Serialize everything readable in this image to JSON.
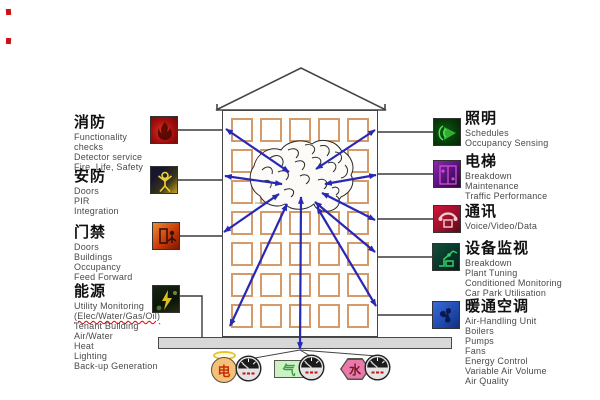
{
  "left_groups": [
    {
      "id": "fire",
      "title": "消防",
      "lines": [
        "Functionality",
        "checks",
        "Detector service",
        "Fire, Life, Safety"
      ]
    },
    {
      "id": "security",
      "title": "安防",
      "lines": [
        "Doors",
        "PIR",
        "Integration"
      ]
    },
    {
      "id": "access",
      "title": "门禁",
      "lines": [
        "Doors",
        "Buildings",
        "Occupancy",
        "Feed Forward"
      ]
    },
    {
      "id": "energy",
      "title": "能源",
      "lines": [
        "Utility Monitoring",
        "(Elec/Water/Gas/Oil)",
        "Tenant Building",
        "Air/Water",
        "Heat",
        "Lighting",
        "Back-up Generation"
      ]
    }
  ],
  "right_groups": [
    {
      "id": "lighting",
      "title": "照明",
      "lines": [
        "Schedules",
        "Occupancy Sensing"
      ]
    },
    {
      "id": "elevator",
      "title": "电梯",
      "lines": [
        "Breakdown",
        "Maintenance",
        "Traffic Performance"
      ]
    },
    {
      "id": "comms",
      "title": "通讯",
      "lines": [
        "Voice/Video/Data"
      ]
    },
    {
      "id": "equipment",
      "title": "设备监视",
      "lines": [
        "Breakdown",
        "Plant Tuning",
        "Conditioned Monitoring",
        "Car Park Utilisation"
      ]
    },
    {
      "id": "hvac",
      "title": "暖通空调",
      "lines": [
        "Air-Handling Unit",
        "Boilers",
        "Pumps",
        "Fans",
        "Energy Control",
        "Variable Air Volume",
        "Air Quality"
      ]
    }
  ],
  "meters": [
    {
      "id": "electricity",
      "label": "电"
    },
    {
      "id": "gas",
      "label": "气"
    },
    {
      "id": "water",
      "label": "水"
    }
  ],
  "building": {
    "window_rows": 7,
    "window_cols": 5
  },
  "spellcheck_underlined": [
    "(Elec/Water/Gas/Oil)"
  ],
  "colors": {
    "arrow": "#2828b4",
    "window-border": "#d49a6a",
    "base-bar": "#d8d8d8",
    "electric": "#f5c078",
    "gas": "#ccf2c4",
    "water": "#e87aae"
  }
}
